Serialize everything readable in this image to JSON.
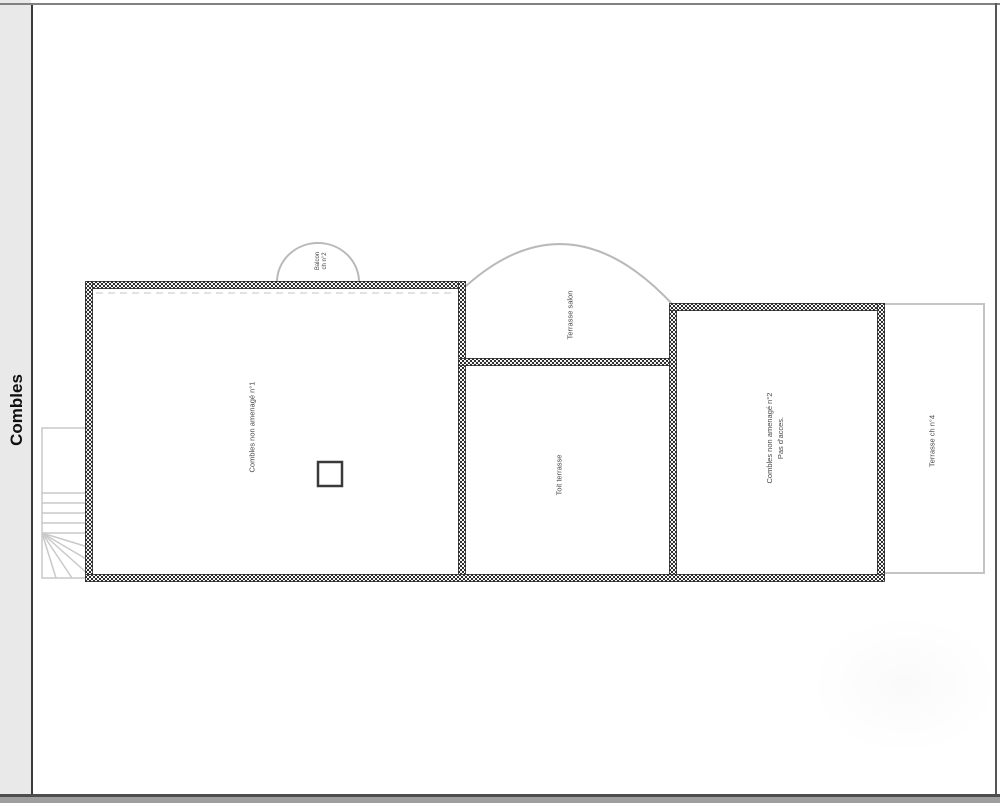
{
  "sidebar": {
    "tab_label": "Combles"
  },
  "plan": {
    "rooms": {
      "attic1": {
        "label": "Combles non amenagé n°1"
      },
      "balcony": {
        "line1": "Balcon",
        "line2": "ch n°2"
      },
      "terrace_lounge": {
        "label": "Terrasse salon"
      },
      "roof_terrace": {
        "label": "Toit terrasse"
      },
      "attic2": {
        "line1": "Combles non amenagé n°2",
        "line2": "Pas d'acces."
      },
      "terrace_ch4": {
        "label": "Terrasse ch n°4"
      }
    },
    "colors": {
      "wall_hatch": "#2e2e2e",
      "thin_outline": "#c4c4c4",
      "arc_stroke": "#b9b9b9",
      "label_text": "#4a4a4a",
      "sidebar_bg": "#e9e9e9",
      "frame_line": "#3a3a3a"
    }
  }
}
